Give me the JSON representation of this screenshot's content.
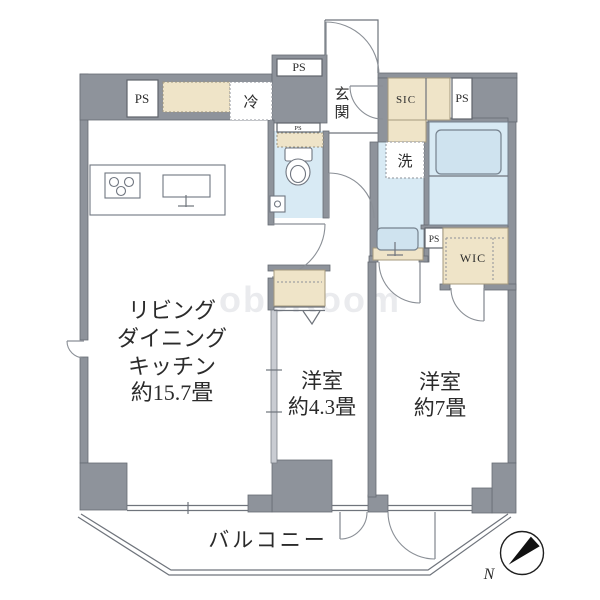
{
  "rooms": {
    "ldk": {
      "lines": [
        "リビング",
        "ダイニング",
        "キッチン",
        "約15.7畳"
      ]
    },
    "bedroom1": {
      "name": "洋室",
      "size": "約4.3畳"
    },
    "bedroom2": {
      "name": "洋室",
      "size": "約7畳"
    },
    "balcony": {
      "name": "バルコニー"
    },
    "entrance": {
      "char1": "玄",
      "char2": "関"
    }
  },
  "fixtures": {
    "refrigerator": "冷",
    "washer": "洗",
    "sic": "SIC",
    "wic": "WIC"
  },
  "ps_labels": {
    "top_left": "PS",
    "top_middle": "PS",
    "toilet_top": "PS",
    "entry_right": "PS",
    "wic_side": "PS"
  },
  "compass": {
    "north": "N"
  },
  "watermark": "oboRoom",
  "colors": {
    "wall": "#8E939B",
    "closet_beige": "#EFE4C8",
    "water_blue": "#D8EAF4",
    "line": "#6f747c"
  }
}
